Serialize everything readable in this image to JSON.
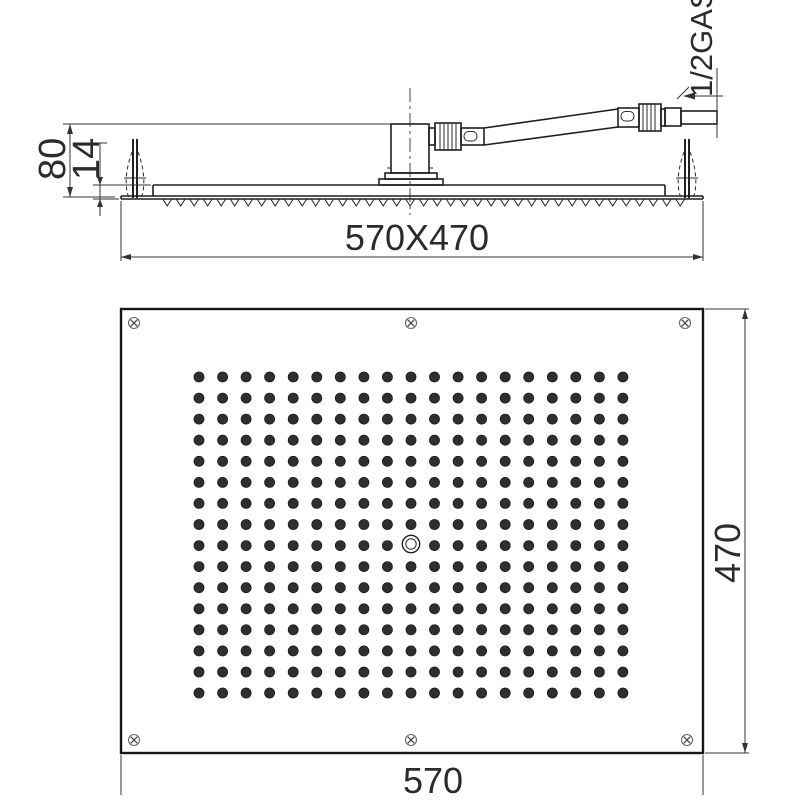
{
  "drawing": {
    "labels": {
      "height": "80",
      "plate_thickness": "14",
      "plate_size": "570X470",
      "connection": "1/2GAS",
      "width": "570",
      "depth": "470"
    },
    "plan": {
      "rect": {
        "x": 121,
        "y": 309,
        "w": 582,
        "h": 444
      },
      "nozzle_grid": {
        "cols": 19,
        "rows": 16,
        "x0": 199,
        "y0": 377,
        "dx": 23.55,
        "dy": 21.07,
        "radius": 5.1,
        "skip": {
          "col": 9,
          "row": 8
        }
      },
      "center_hole": {
        "cx": 411,
        "cy": 544,
        "r_outer": 8.7,
        "r_inner": 5.2
      },
      "screws": [
        [
          134,
          323
        ],
        [
          411,
          323
        ],
        [
          685,
          323
        ],
        [
          134,
          740
        ],
        [
          411,
          740
        ],
        [
          687,
          740
        ]
      ],
      "screw_radius": 5.5
    },
    "teeth": {
      "x0": 163,
      "x1": 690,
      "step": 13.5,
      "depth": 6.5,
      "y": 199.5
    },
    "colors": {
      "line": "#1f1f1f",
      "dim": "#333333",
      "nozzle": "#2f2f2f",
      "screw": "#666666",
      "background": "#ffffff"
    }
  }
}
